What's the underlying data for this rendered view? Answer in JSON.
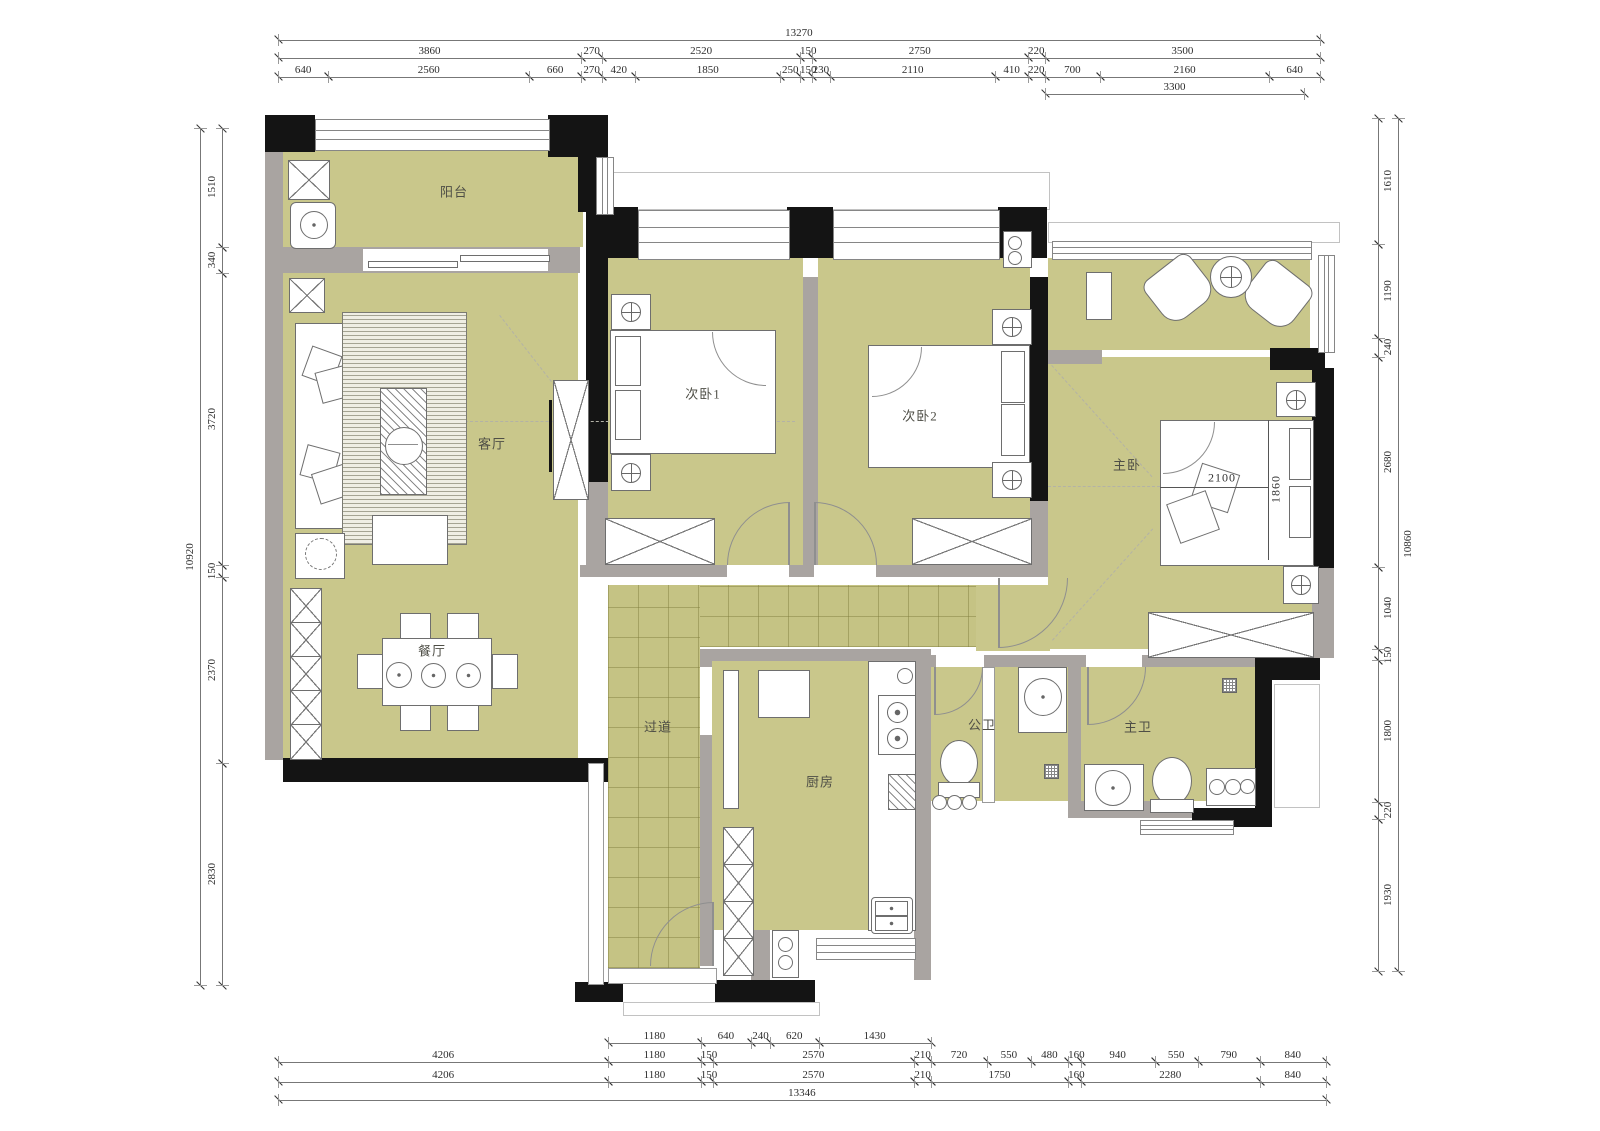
{
  "rooms": {
    "balcony": "阳台",
    "living": "客厅",
    "bed1": "次卧1",
    "bed2": "次卧2",
    "master": "主卧",
    "dining": "餐厅",
    "hallway": "过道",
    "kitchen": "厨房",
    "bath_public": "公卫",
    "bath_master": "主卫"
  },
  "bed_dims": {
    "width": "2100",
    "depth": "1860"
  },
  "colors": {
    "floor": "#c9c78b",
    "wall": "#a9a4a1",
    "column": "#141414"
  },
  "dims": {
    "top": {
      "total": [
        13270
      ],
      "majors": [
        3860,
        270,
        2520,
        150,
        2750,
        220,
        3500
      ],
      "minors": [
        640,
        2560,
        660,
        270,
        420,
        1850,
        250,
        150,
        230,
        2110,
        410,
        220,
        700,
        2160,
        640
      ],
      "offset": [
        {
          "v": 9770,
          "blank": true
        },
        {
          "v": 3300
        },
        {
          "v": 200,
          "blank": true
        }
      ]
    },
    "bottom": {
      "partial": [
        {
          "v": 4206,
          "blank": true
        },
        1180,
        640,
        240,
        620,
        1430,
        {
          "v": 5030,
          "blank": true
        }
      ],
      "minors": [
        4206,
        1180,
        150,
        2570,
        210,
        720,
        550,
        480,
        160,
        940,
        550,
        790,
        840
      ],
      "majors": [
        4206,
        1180,
        150,
        2570,
        210,
        1750,
        160,
        2280,
        840
      ],
      "total": [
        13346
      ]
    },
    "left": {
      "chain": [
        1510,
        340,
        3720,
        150,
        2370,
        2830
      ],
      "total": [
        10920
      ]
    },
    "right": {
      "chain": [
        1610,
        1190,
        240,
        2680,
        1040,
        150,
        1800,
        220,
        1930
      ],
      "total": [
        10860
      ]
    }
  }
}
